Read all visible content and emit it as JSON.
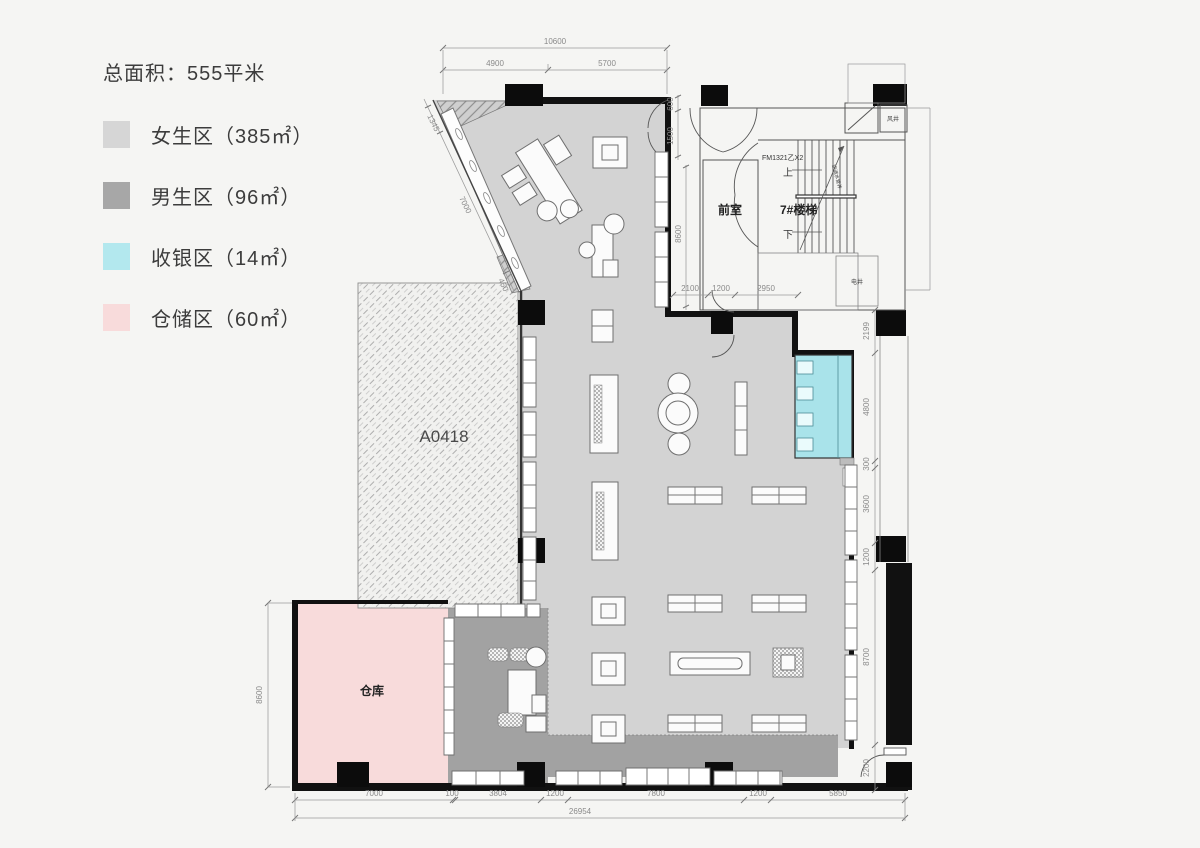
{
  "overview": {
    "title": "总面积：555平米"
  },
  "legend": {
    "items": [
      {
        "label": "女生区（385㎡）",
        "color": "#d6d6d6"
      },
      {
        "label": "男生区（96㎡）",
        "color": "#a7a7a7"
      },
      {
        "label": "收银区（14㎡）",
        "color": "#b3e8ee"
      },
      {
        "label": "仓储区（60㎡）",
        "color": "#f8dbdb"
      }
    ]
  },
  "plan": {
    "floor_colors": {
      "women": "#d3d3d3",
      "men": "#a2a2a2",
      "cashier": "#a9e3ea",
      "warehouse": "#f8dbdb"
    },
    "labels": {
      "unit": "A0418",
      "warehouse": "仓库",
      "vestibule": "前室",
      "stair": "7#楼梯",
      "door_code": "FM1321乙X2",
      "up": "上",
      "down": "下",
      "wind_shaft": "风井",
      "pipe_shaft": "空调水管井",
      "utility_shaft": "电井"
    },
    "dims": {
      "top": {
        "total": "10600",
        "segments": [
          "4900",
          "5700"
        ]
      },
      "diagonal": [
        "1345",
        "7000",
        "450"
      ],
      "vestibule_side": [
        "600",
        "1500",
        "8600"
      ],
      "below_vestibule": [
        "2100",
        "1200",
        "2950"
      ],
      "right": [
        "2199",
        "4800",
        "300",
        "3600",
        "1200",
        "8700",
        "2200"
      ],
      "left": "8600",
      "bottom": {
        "segments": [
          "7000",
          "100",
          "3804",
          "1200",
          "7800",
          "1200",
          "5850"
        ],
        "total": "26954"
      }
    }
  }
}
